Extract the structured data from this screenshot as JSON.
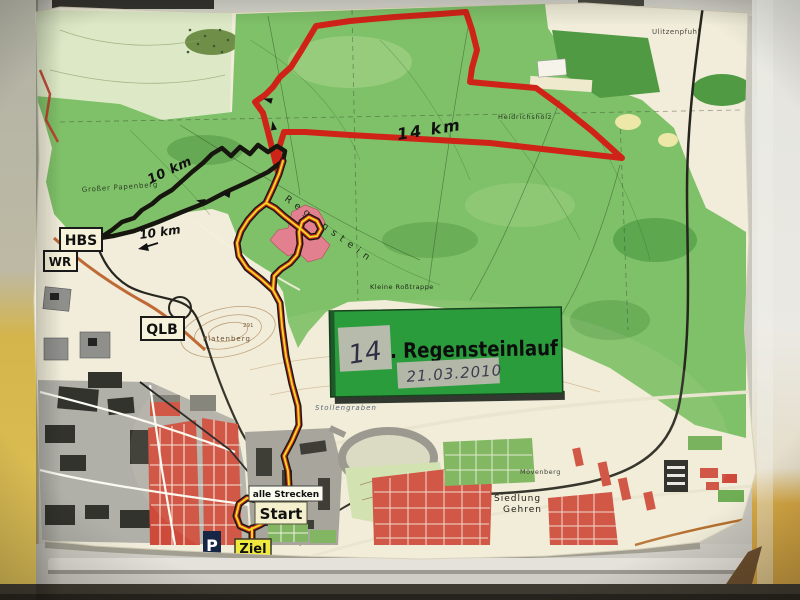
{
  "sign": {
    "race_number": "14",
    "title": ". Regensteinlauf",
    "date": "21.03.2010"
  },
  "route_labels": {
    "red": "14 km",
    "black_upper": "10 km",
    "black_lower": "10 km"
  },
  "destination_boxes": {
    "hbs": "HBS",
    "wr": "WR",
    "qlb": "QLB"
  },
  "course_markers": {
    "all_tracks": "alle Strecken",
    "start": "Start",
    "finish": "Ziel",
    "parking": "P"
  },
  "place_names": {
    "papenberg": "Großer Papenberg",
    "regenstein": "Regenstein",
    "rosstrappe": "Kleine Roßtrappe",
    "heidrichsholz": "Heidrichshölz",
    "ulitzenpfuhl": "Ulitzenpfuhl",
    "platenberg": "Platenberg",
    "platenberg_elevation": "291",
    "stollengraben": "Stollengraben",
    "moevenberg": "Mövenberg",
    "siedlung_line1": "Siedlung",
    "siedlung_line2": "Gehren"
  },
  "colors": {
    "route_red": "#d02318",
    "route_black": "#16160f",
    "route_yellow": "#f1d822",
    "forest_green": "#7fc168",
    "sign_green": "#2a9c3c",
    "urban_red": "#ce4a3b",
    "paper_beige": "#f1edda",
    "wall_yellow": "#d8b94c"
  }
}
